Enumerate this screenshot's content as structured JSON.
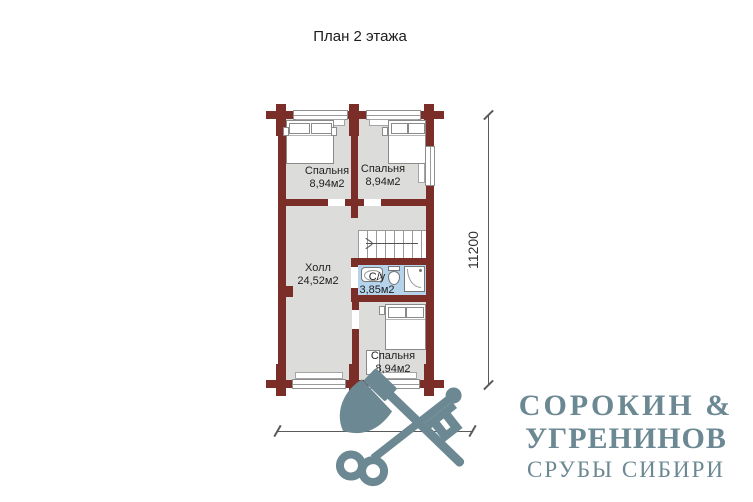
{
  "title": "План 2 этажа",
  "plan": {
    "rooms": {
      "bedroom1": {
        "label": "Спальня",
        "area": "8,94м2"
      },
      "bedroom2": {
        "label": "Спальня",
        "area": "8,94м2"
      },
      "bedroom3": {
        "label": "Спальня",
        "area": "8,94м2"
      },
      "hall": {
        "label": "Холл",
        "area": "24,52м2"
      },
      "bathroom": {
        "label": "С/у",
        "area": "3,85м2"
      }
    },
    "dimensions": {
      "vertical": "11200",
      "horizontal": "6000"
    },
    "colors": {
      "wall": "#7b2e28",
      "floor": "#dcdcda",
      "bathroom_floor": "#b5d3eb",
      "logo": "#6b8893"
    }
  },
  "logo": {
    "name_line1": "СОРОКИН &",
    "name_line2": "УГРЕНИНОВ",
    "tagline": "СРУБЫ СИБИРИ",
    "icon": "axe-and-key-crossed-icon"
  }
}
